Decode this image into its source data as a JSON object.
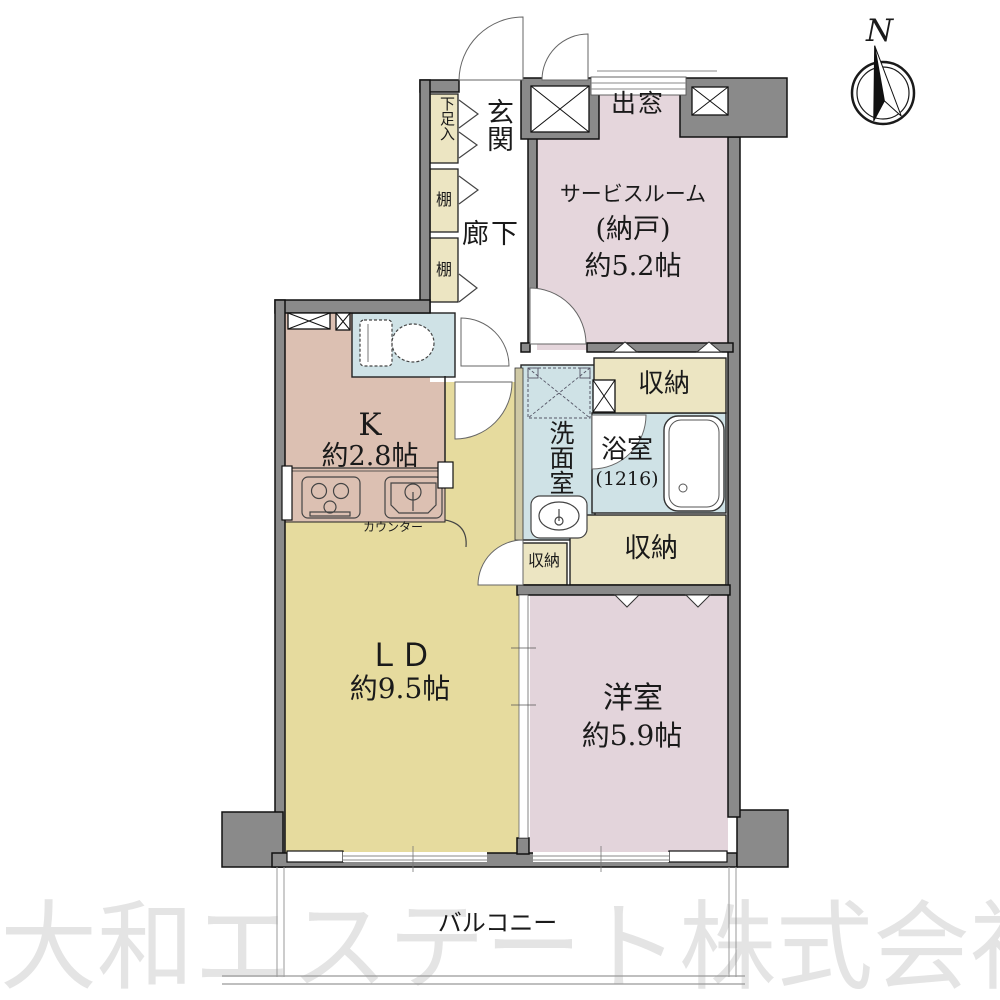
{
  "compass": {
    "north_label": "N"
  },
  "watermark": {
    "text": "大和エステート株式会社",
    "color": "#e4e4e4"
  },
  "balcony": {
    "label": "バルコニー"
  },
  "colors": {
    "wall": "#8a8a8a",
    "storage": "#ece5c2",
    "hall_white": "#ffffff",
    "counter_wall": "#cfc9a5"
  },
  "rooms": {
    "entrance": {
      "label": "玄関"
    },
    "shoe_cabinet": {
      "label": "下足入"
    },
    "shelf_upper": {
      "label": "棚"
    },
    "shelf_lower": {
      "label": "棚"
    },
    "corridor": {
      "label": "廊下"
    },
    "bay_window": {
      "label": "出窓"
    },
    "service_room": {
      "name": "サービスルーム",
      "alt_name": "(納戸)",
      "size": "約5.2帖",
      "color": "#e5d6dc"
    },
    "kitchen": {
      "name": "K",
      "size": "約2.8帖",
      "counter_label": "カウンター",
      "color": "#dcc0b2"
    },
    "toilet": {
      "color": "#cfe2e6"
    },
    "washroom": {
      "label": "洗面室",
      "color": "#cfe2e6"
    },
    "bathroom": {
      "name": "浴室",
      "size": "(1216)",
      "color": "#cfe2e6"
    },
    "storage_top": {
      "label": "収納"
    },
    "storage_mid": {
      "label": "収納"
    },
    "storage_bottom": {
      "label": "収納"
    },
    "living_dining": {
      "name": "ＬＤ",
      "size": "約9.5帖",
      "color": "#e6db9e"
    },
    "western_room": {
      "name": "洋室",
      "size": "約5.9帖",
      "color": "#e3d4db"
    }
  }
}
